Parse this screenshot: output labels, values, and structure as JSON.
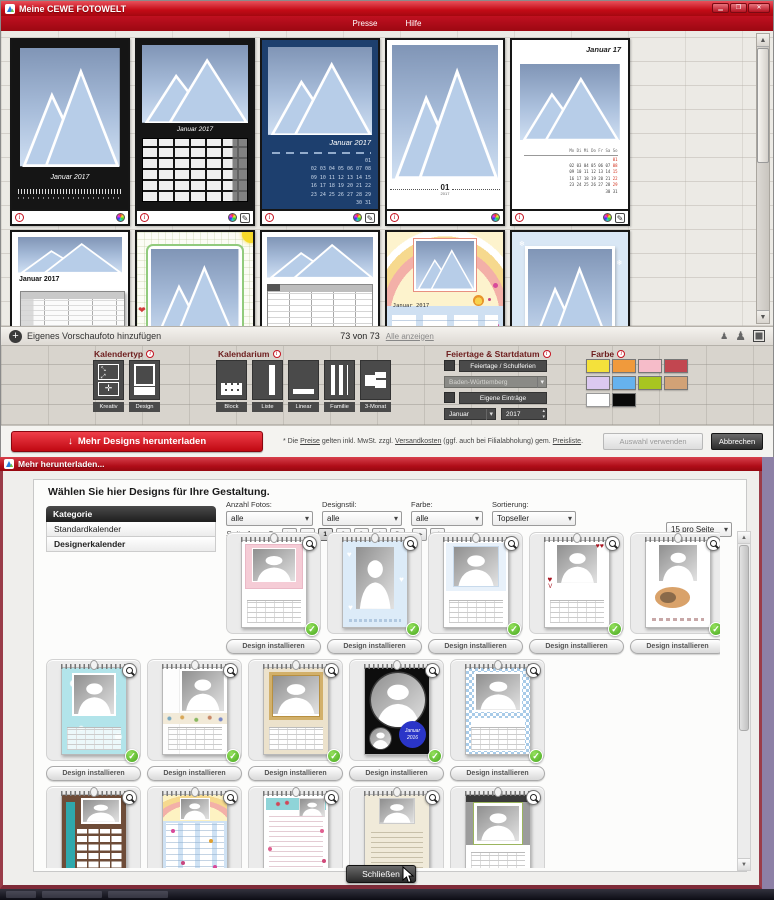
{
  "window1": {
    "title": "Meine CEWE FOTOWELT",
    "menu": [
      "Presse",
      "Hilfe"
    ],
    "templates": [
      {
        "variant": "black-linear",
        "label": "Januar 2017",
        "edit": false
      },
      {
        "variant": "black-block",
        "label": "Januar 2017",
        "edit": true
      },
      {
        "variant": "blue-grid",
        "label": "Januar 2017",
        "edit": true
      },
      {
        "variant": "white-timeline",
        "label": "01",
        "sublabel": "2017",
        "edit": false
      },
      {
        "variant": "white-classic",
        "label": "Januar 17",
        "edit": true
      },
      {
        "variant": "white-list",
        "label": "Januar 2017",
        "edit": true
      },
      {
        "variant": "doodle",
        "label": "",
        "edit": true
      },
      {
        "variant": "family-table",
        "label": "",
        "edit": true
      },
      {
        "variant": "kids-rainbow",
        "label": "Januar 2017",
        "edit": true
      },
      {
        "variant": "winter",
        "label": "",
        "edit": true
      },
      {
        "variant": "orange-list",
        "label": "Januar 17",
        "edit": true
      },
      {
        "variant": "white-2017",
        "label": "2017",
        "edit": true
      }
    ],
    "day_header": "Mo Di Mi Do Fr Sa So",
    "jan_rows": [
      "01",
      "02 03 04 05 06 07 08",
      "09 10 11 12 13 14 15",
      "16 17 18 19 20 21 22",
      "23 24 25 26 27 28 29",
      "30 31"
    ],
    "preview_bar": {
      "add_label": "Eigenes Vorschaufoto hinzufügen",
      "count": "73 von 73",
      "show_all": "Alle anzeigen"
    },
    "filters": {
      "kalendertyp": {
        "label": "Kalendertyp",
        "options": [
          "Kreativ",
          "Design"
        ]
      },
      "kalendarium": {
        "label": "Kalendarium",
        "options": [
          "Block",
          "Liste",
          "Linear",
          "Familie",
          "3-Monat"
        ]
      },
      "feiertage": {
        "label": "Feiertage & Startdatum",
        "holidays_button": "Feiertage / Schulferien",
        "region": "Baden-Württemberg",
        "custom_button": "Eigene Einträge",
        "month": "Januar",
        "year": "2017"
      },
      "farbe": {
        "label": "Farbe",
        "colors": [
          "#f4e13b",
          "#f09a3c",
          "#f6bcc9",
          "#c24650",
          "#dcc9f0",
          "#66b2ee",
          "#a8c520",
          "#d2a276",
          "#ffffff",
          "#0a0a0a"
        ]
      }
    },
    "footer": {
      "download_button": "Mehr Designs herunterladen",
      "note_parts": [
        "* Die ",
        "Preise",
        " gelten inkl. MwSt. zzgl. ",
        "Versandkosten",
        " (ggf. auch bei Filialabholung) gem. ",
        "Preisliste",
        "."
      ],
      "use_button": "Auswahl verwenden",
      "cancel_button": "Abbrechen"
    }
  },
  "window2": {
    "title": "Mehr herunterladen...",
    "heading": "Wählen Sie hier Designs für Ihre Gestaltung.",
    "sidebar": {
      "header": "Kategorie",
      "items": [
        "Standardkalender",
        "Designerkalender"
      ],
      "selected_index": 1
    },
    "filters": [
      {
        "label": "Anzahl Fotos:",
        "value": "alle"
      },
      {
        "label": "Designstil:",
        "value": "alle"
      },
      {
        "label": "Farbe:",
        "value": "alle"
      },
      {
        "label": "Sortierung:",
        "value": "Topseller"
      }
    ],
    "pagination": {
      "page_label": "Seite 1 von 5",
      "pages": [
        "1",
        "2",
        "3",
        "4",
        "5"
      ],
      "current": "1",
      "first": "|◂",
      "prev": "◂◂",
      "next": "▸▸",
      "last": "▸|"
    },
    "per_page": "15 pro Seite",
    "install_label": "Design installieren",
    "designs": [
      {
        "variant": "pink",
        "installed": true
      },
      {
        "variant": "bluehearts",
        "installed": true
      },
      {
        "variant": "lightblue",
        "installed": true
      },
      {
        "variant": "redhearts",
        "installed": true
      },
      {
        "variant": "cats",
        "installed": true
      },
      {
        "variant": "turquoise",
        "installed": true
      },
      {
        "variant": "patternstrip",
        "installed": true
      },
      {
        "variant": "gold",
        "installed": true
      },
      {
        "variant": "blackcircles",
        "installed": true,
        "label": "Januar 2016"
      },
      {
        "variant": "bluecheck",
        "installed": true
      },
      {
        "variant": "brownplanner",
        "installed": false
      },
      {
        "variant": "kidsplanner",
        "installed": false
      },
      {
        "variant": "pinklist",
        "installed": false
      },
      {
        "variant": "beigelist",
        "installed": false
      },
      {
        "variant": "grayclassic",
        "installed": false
      }
    ],
    "close_button": "Schließen"
  }
}
